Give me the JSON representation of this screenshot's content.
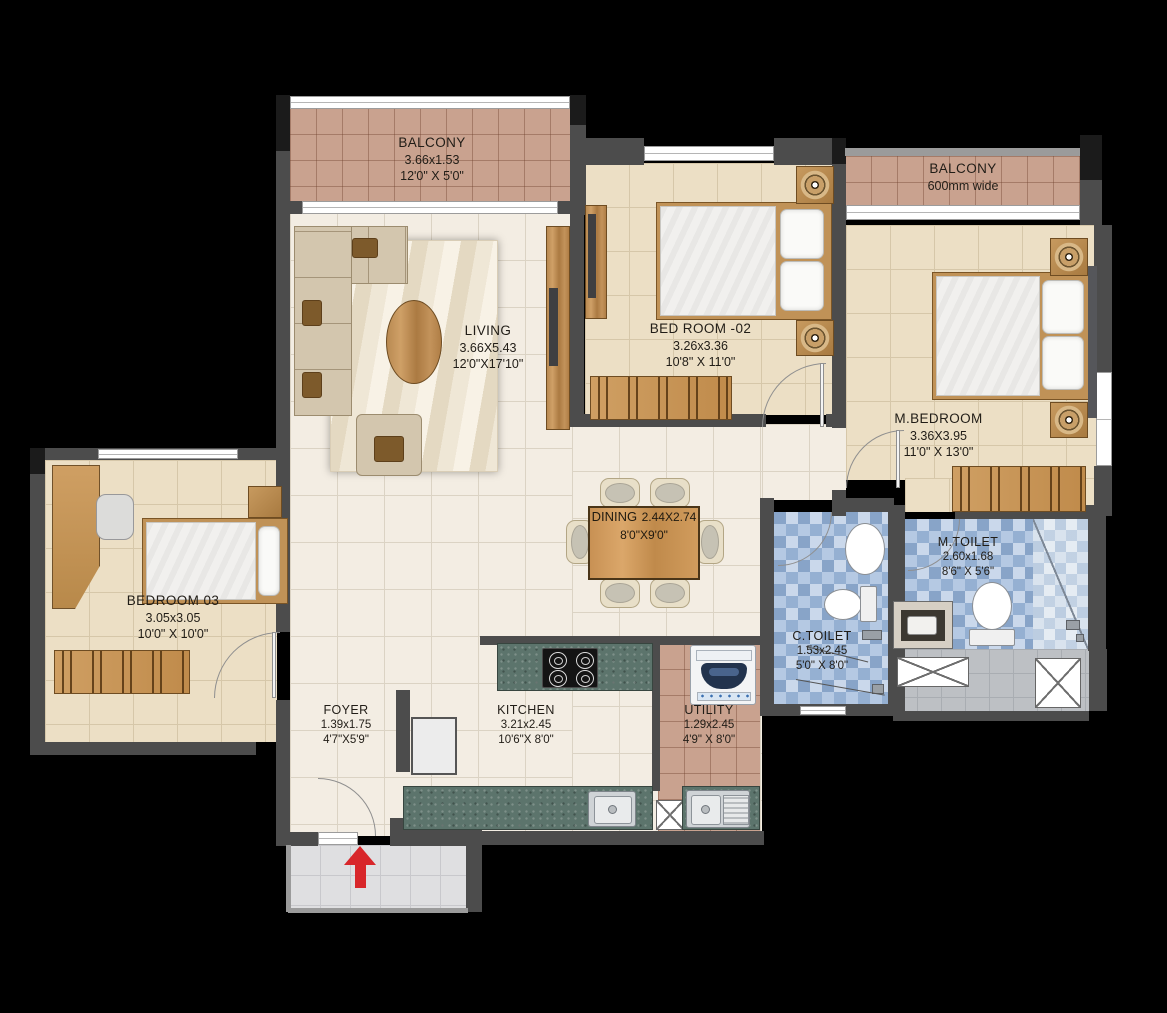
{
  "plan_title": "2BHK-style apartment floor plan",
  "rooms": {
    "balcony_top_left": {
      "name": "BALCONY",
      "dim_m": "3.66x1.53",
      "dim_ft": "12'0\" X 5'0\""
    },
    "living": {
      "name": "LIVING",
      "dim_m": "3.66X5.43",
      "dim_ft": "12'0\"X17'10\""
    },
    "bedroom_02": {
      "name": "BED ROOM -02",
      "dim_m": "3.26x3.36",
      "dim_ft": "10'8\" X 11'0\""
    },
    "balcony_top_right": {
      "name": "BALCONY",
      "dim_note": "600mm wide"
    },
    "master_bedroom": {
      "name": "M.BEDROOM",
      "dim_m": "3.36X3.95",
      "dim_ft": "11'0\" X 13'0\""
    },
    "bedroom_03": {
      "name": "BEDROOM 03",
      "dim_m": "3.05x3.05",
      "dim_ft": "10'0\" X 10'0\""
    },
    "dining": {
      "name": "DINING",
      "dim_m": "2.44X2.74",
      "dim_ft": "8'0\"X9'0\""
    },
    "master_toilet": {
      "name": "M.TOILET",
      "dim_m": "2.60x1.68",
      "dim_ft": "8'6\" X 5'6\""
    },
    "common_toilet": {
      "name": "C.TOILET",
      "dim_m": "1.53x2.45",
      "dim_ft": "5'0\" X 8'0\""
    },
    "foyer": {
      "name": "FOYER",
      "dim_m": "1.39x1.75",
      "dim_ft": "4'7\"X5'9\""
    },
    "kitchen": {
      "name": "KITCHEN",
      "dim_m": "3.21x2.45",
      "dim_ft": "10'6\"X 8'0\""
    },
    "utility": {
      "name": "UTILITY",
      "dim_m": "1.29x2.45",
      "dim_ft": "4'9\" X 8'0\""
    }
  },
  "colors": {
    "background": "#000000",
    "wall": "#4c4c4c",
    "living_floor": "#f3ede3",
    "bedroom_floor": "#ecdfc5",
    "balcony_tile": "#c9a28f",
    "toilet_tile": "#a9c0de",
    "granite_counter": "#5c746c",
    "wood": "#c08d55",
    "entry_arrow": "#d8262a"
  }
}
